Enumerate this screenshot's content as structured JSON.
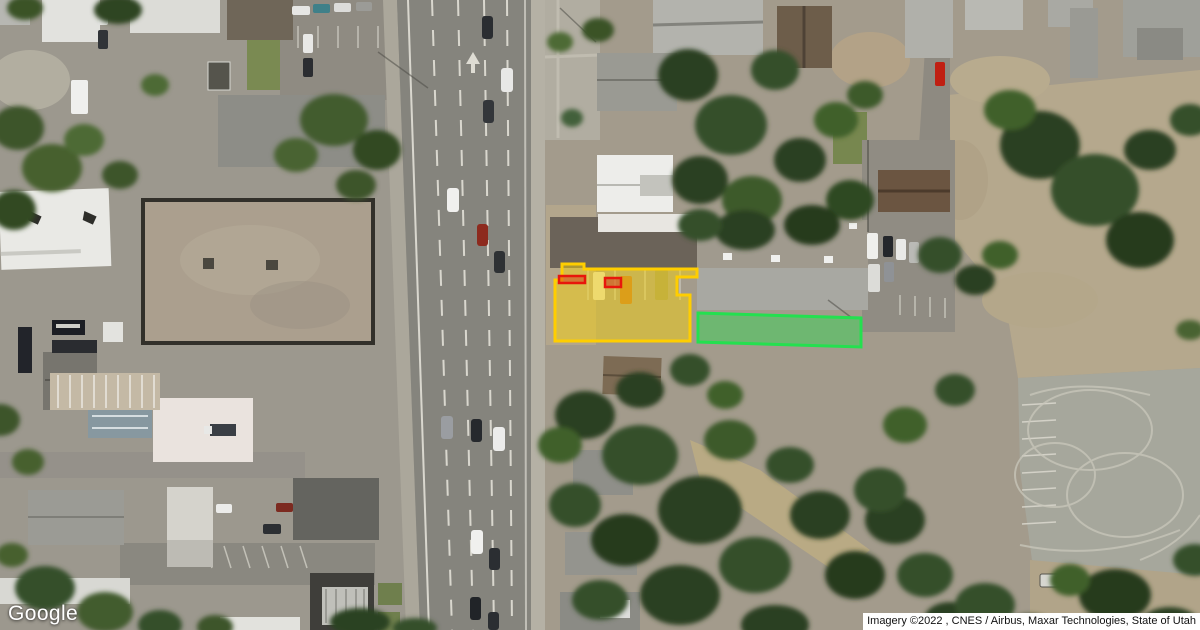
{
  "map": {
    "logo": "Google",
    "attribution": "Imagery ©2022 , CNES / Airbus, Maxar Technologies, State of Utah",
    "view": "satellite"
  },
  "overlays": {
    "parcel_yellow": {
      "points": "555,280 562,280 562,264 584,264 584,269 697,269 697,277 677,277 677,295 690,295 690,341 555,341",
      "stroke": "#FFCE00",
      "fill": "rgba(255,214,0,0.45)"
    },
    "red_box_a": {
      "points": "559,276 585,276 585,283 559,283",
      "stroke": "#E8170B",
      "fill": "rgba(210,40,25,0.45)"
    },
    "red_box_b": {
      "points": "605,278 621,278 621,287 605,287",
      "stroke": "#E8170B",
      "fill": "rgba(210,40,25,0.45)"
    },
    "parcel_green": {
      "points": "698,313 861,318 861,347 698,342",
      "stroke": "#24E04F",
      "fill": "rgba(46,218,80,0.45)"
    }
  }
}
